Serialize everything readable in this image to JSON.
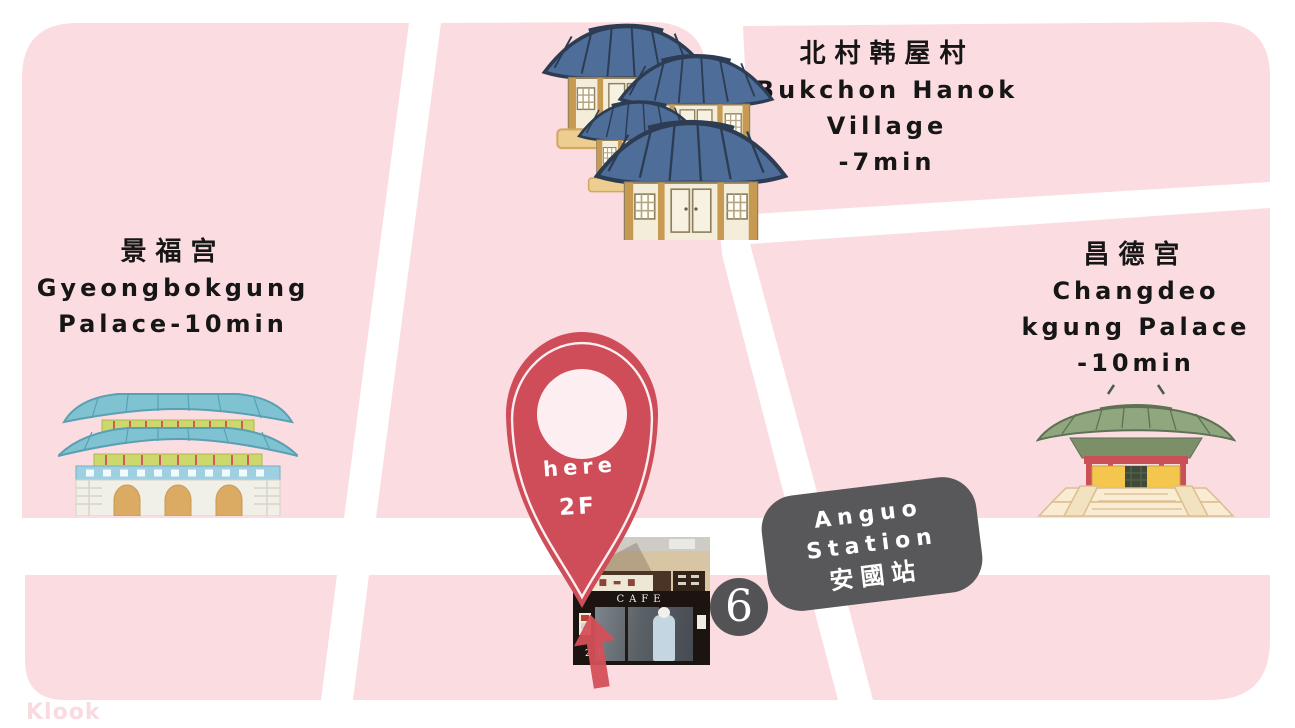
{
  "map": {
    "background_color": "#ffffff",
    "block_color": "#fbdce1",
    "watermark": "Klook"
  },
  "landmarks": {
    "gyeongbokgung": {
      "name_cjk": "景福宫",
      "name_line1": "Gyeongbokgung",
      "name_line2": "Palace-10min"
    },
    "bukchon": {
      "name_cjk": "北村韩屋村",
      "name_line1": "Bukchon Hanok",
      "name_line2": "Village",
      "name_line3": "-7min"
    },
    "changdeokgung": {
      "name_cjk": "昌德宫",
      "name_line1": "Changdeo",
      "name_line2": "kgung Palace",
      "name_line3": "-10min"
    }
  },
  "pin": {
    "line1": "here",
    "line2": "2F",
    "color": "#ce4d59"
  },
  "station": {
    "line1": "Anguo",
    "line2": "Station",
    "line3": "安國站",
    "bg_color": "#58585a"
  },
  "subway_badge": {
    "number": "6",
    "bg_color": "#535355"
  },
  "photo": {
    "cafe_sign": "CAFE",
    "floor_label": "2 F"
  }
}
